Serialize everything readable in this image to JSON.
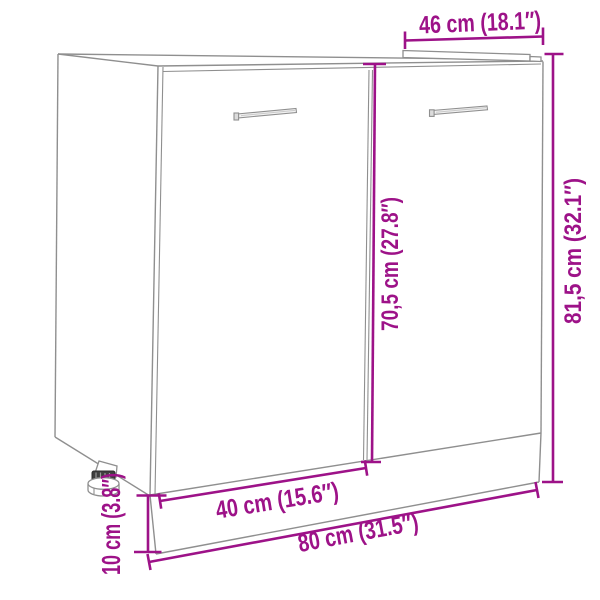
{
  "diagram": {
    "type": "furniture-dimension-drawing",
    "subject": "two-door sink base cabinet with adjustable foot",
    "accent_color": "#9D1288",
    "outline_color": "#8f8f8f",
    "background_color": "#ffffff",
    "dimensions": {
      "top_depth": {
        "label": "46 cm (18.1″)"
      },
      "total_height": {
        "label": "81,5 cm (32.1″)"
      },
      "door_height": {
        "label": "70,5 cm (27.8″)"
      },
      "door_width": {
        "label": "40 cm (15.6″)"
      },
      "total_width": {
        "label": "80 cm (31.5″)"
      },
      "plinth_height": {
        "label": "10 cm (3.8″)"
      }
    }
  }
}
